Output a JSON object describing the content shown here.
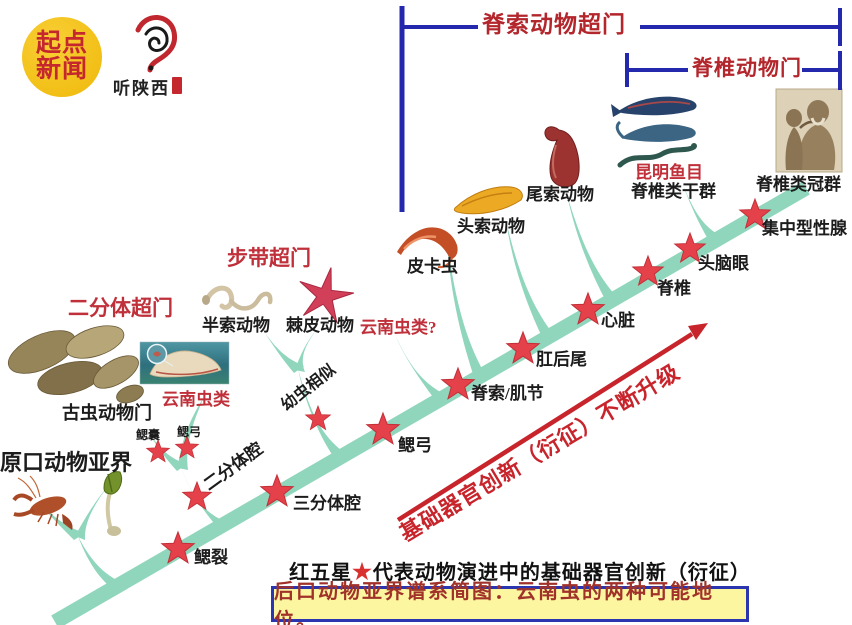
{
  "branding": {
    "qidian_line1": "起点",
    "qidian_line2": "新闻",
    "ear_logo_text": "听陕西"
  },
  "brackets": {
    "chordate_superphylum": "脊索动物超门",
    "vertebrate_phylum": "脊椎动物门"
  },
  "taxa": {
    "protostomia": "原口动物亚界",
    "vetulicolia_superphylum": "二分体超门",
    "vetulicolia": "古虫动物门",
    "yunnanozoa": "云南虫类",
    "ambulacraria_superphylum": "步带超门",
    "hemichordate": "半索动物",
    "echinoderm": "棘皮动物",
    "yunnanozoa_alt": "云南虫类?",
    "pikaia": "皮卡虫",
    "cephalochordate": "头索动物",
    "urochordate": "尾索动物",
    "myllokunmingiida": "昆明鱼目",
    "vertebrate_stem": "脊椎类干群",
    "vertebrate_crown": "脊椎类冠群"
  },
  "innovations": {
    "gill_slits": "鳃裂",
    "two_part_coelom": "二分体腔",
    "three_part_coelom": "三分体腔",
    "gill_pouch": "鳃囊",
    "gill_arch_branch": "鳃弓",
    "larva_similar": "幼虫相似",
    "gill_arch": "鳃弓",
    "notochord_myomere": "脊索/肌节",
    "postanal_tail": "肛后尾",
    "heart": "心脏",
    "vertebra": "脊椎",
    "head_brain_eye": "头脑眼",
    "concentrated_gonad": "集中型性腺"
  },
  "arrow_text": "基础器官创新（衍征）不断升级",
  "captions": {
    "legend_prefix": "红五星",
    "legend_star": "★",
    "legend_suffix": "代表动物演进中的基础器官创新（衍征）",
    "title_box": "后口动物亚界谱系简图：云南虫的两种可能地位。"
  },
  "colors": {
    "band_teal": "#8FD6BC",
    "star_red": "#E5414B",
    "bracket_blue": "#2328AC",
    "label_red": "#C0303A",
    "arrow_red": "#C8242C",
    "box_yellow": "#FCF6A0",
    "logo_yellow": "#F1BE14"
  }
}
